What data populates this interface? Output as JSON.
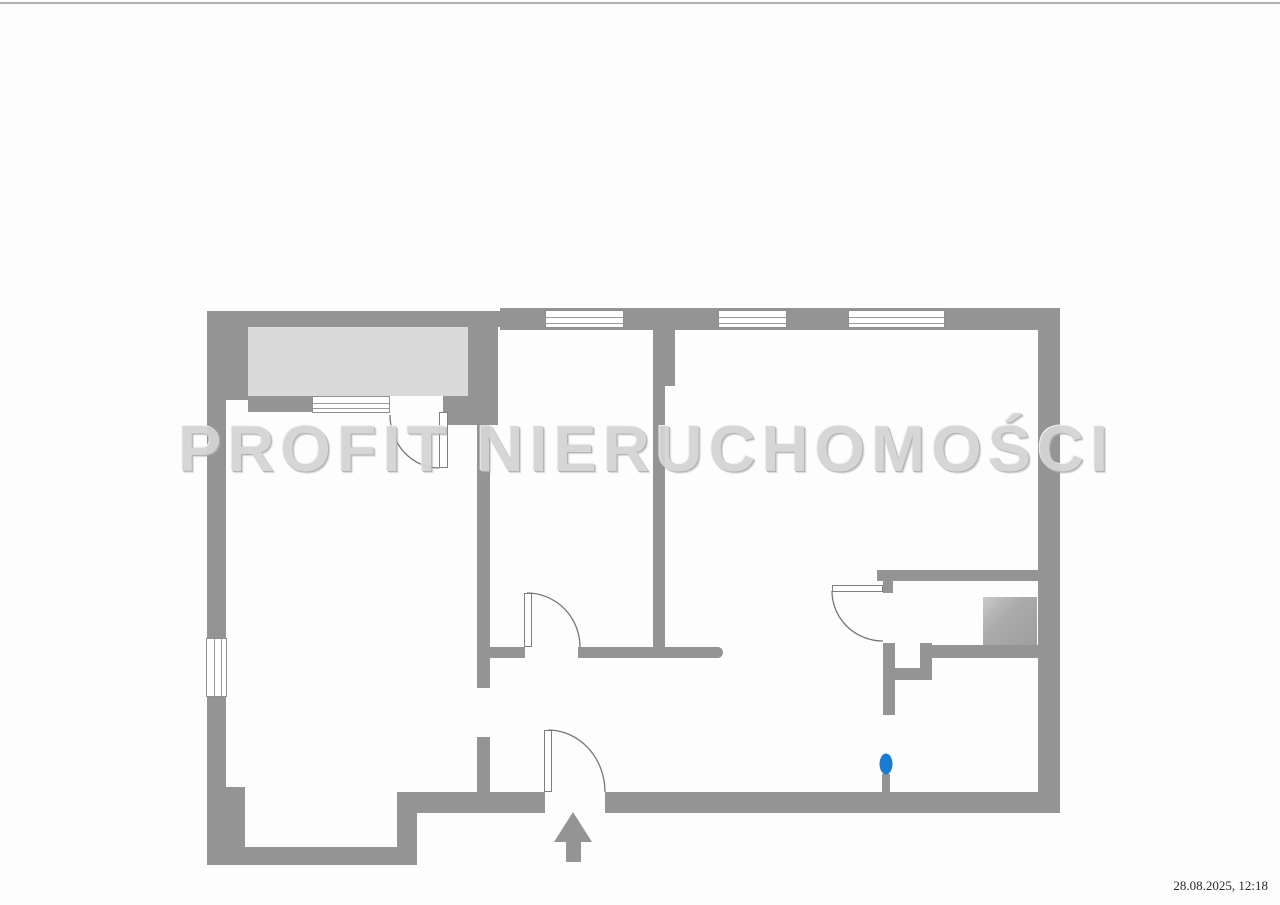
{
  "page": {
    "timestamp": "28.08.2025, 12:18",
    "background": "#fdfdfd",
    "scan_line_color": "#b2b2b2"
  },
  "watermark": {
    "text": "PROFIT NIERUCHOMOŚCI",
    "color": "#d4d4d4"
  },
  "colors": {
    "wall": "#949494",
    "balcony_fill": "#d9d9d9",
    "appliance_fill": "#a8a8a8",
    "marker_blue": "#1a7cd0",
    "door_line": "#767676"
  },
  "plan": {
    "walls": [
      {
        "name": "top-wall-balcony",
        "x": 207,
        "y": 311,
        "w": 293,
        "h": 16
      },
      {
        "name": "top-wall-main",
        "x": 500,
        "y": 308,
        "w": 560,
        "h": 22
      },
      {
        "name": "left-wall-upper",
        "x": 207,
        "y": 311,
        "w": 41,
        "h": 89
      },
      {
        "name": "left-wall",
        "x": 207,
        "y": 398,
        "w": 19,
        "h": 392
      },
      {
        "name": "left-wall-bottom",
        "x": 207,
        "y": 787,
        "w": 38,
        "h": 78
      },
      {
        "name": "bottom-wall-left",
        "x": 207,
        "y": 847,
        "w": 190,
        "h": 18
      },
      {
        "name": "bottom-step",
        "x": 397,
        "y": 792,
        "w": 20,
        "h": 73
      },
      {
        "name": "bottom-wall-mid",
        "x": 417,
        "y": 792,
        "w": 128,
        "h": 21
      },
      {
        "name": "bottom-wall-right",
        "x": 605,
        "y": 792,
        "w": 455,
        "h": 21
      },
      {
        "name": "right-wall",
        "x": 1038,
        "y": 308,
        "w": 22,
        "h": 505
      },
      {
        "name": "balcony-right-wall",
        "x": 468,
        "y": 327,
        "w": 30,
        "h": 70
      },
      {
        "name": "balcony-bottom-wall-left",
        "x": 248,
        "y": 396,
        "w": 65,
        "h": 16
      },
      {
        "name": "balcony-bottom-wall-right",
        "x": 443,
        "y": 396,
        "w": 55,
        "h": 29
      },
      {
        "name": "divider-left-upper",
        "x": 477,
        "y": 420,
        "w": 13,
        "h": 268
      },
      {
        "name": "divider-left-lower",
        "x": 477,
        "y": 737,
        "w": 13,
        "h": 56
      },
      {
        "name": "divider-mid-upper",
        "x": 653,
        "y": 330,
        "w": 22,
        "h": 56
      },
      {
        "name": "divider-mid-lower",
        "x": 653,
        "y": 385,
        "w": 12,
        "h": 273
      },
      {
        "name": "hall-wall-stub",
        "x": 490,
        "y": 647,
        "w": 35,
        "h": 11
      },
      {
        "name": "hall-wall-main",
        "x": 578,
        "y": 647,
        "w": 145,
        "h": 11,
        "r": "0 6px 6px 0"
      },
      {
        "name": "bath-top-wall",
        "x": 877,
        "y": 570,
        "w": 161,
        "h": 11
      },
      {
        "name": "bath-door-stub",
        "x": 883,
        "y": 581,
        "w": 10,
        "h": 12
      },
      {
        "name": "bath-wall-a",
        "x": 883,
        "y": 643,
        "w": 12,
        "h": 72
      },
      {
        "name": "bath-wall-b",
        "x": 895,
        "y": 668,
        "w": 35,
        "h": 12
      },
      {
        "name": "bath-wall-c",
        "x": 920,
        "y": 643,
        "w": 12,
        "h": 37
      },
      {
        "name": "bath-wall-d",
        "x": 932,
        "y": 645,
        "w": 106,
        "h": 13
      },
      {
        "name": "marker-stub",
        "x": 882,
        "y": 774,
        "w": 8,
        "h": 20
      },
      {
        "name": "entrance-arrow-shaft",
        "x": 566,
        "y": 840,
        "w": 15,
        "h": 22
      }
    ],
    "fills": [
      {
        "name": "balcony-floor",
        "x": 248,
        "y": 327,
        "w": 220,
        "h": 69,
        "kind": "balcony"
      },
      {
        "name": "bathroom-appliance",
        "x": 983,
        "y": 597,
        "w": 54,
        "h": 48,
        "kind": "appliance"
      }
    ],
    "windows": [
      {
        "name": "window-top-1",
        "x": 545,
        "y": 310,
        "w": 79,
        "h": 18,
        "o": "h"
      },
      {
        "name": "window-top-2",
        "x": 718,
        "y": 310,
        "w": 69,
        "h": 18,
        "o": "h"
      },
      {
        "name": "window-top-3",
        "x": 848,
        "y": 310,
        "w": 97,
        "h": 18,
        "o": "h"
      },
      {
        "name": "window-left",
        "x": 206,
        "y": 638,
        "w": 21,
        "h": 59,
        "o": "v"
      },
      {
        "name": "window-balcony",
        "x": 312,
        "y": 396,
        "w": 78,
        "h": 17,
        "o": "h"
      }
    ],
    "door_leaves": [
      {
        "name": "balcony-door-leaf",
        "x": 439,
        "y": 412,
        "w": 9,
        "h": 56
      },
      {
        "name": "kitchen-door-leaf",
        "x": 524,
        "y": 593,
        "w": 8,
        "h": 54
      },
      {
        "name": "entrance-door-leaf",
        "x": 544,
        "y": 730,
        "w": 8,
        "h": 62
      },
      {
        "name": "bathroom-door-leaf",
        "x": 832,
        "y": 585,
        "w": 51,
        "h": 7
      }
    ],
    "door_arcs": [
      {
        "name": "balcony-door-arc",
        "d": "M390,415 A49,53 0 0 0 439,468"
      },
      {
        "name": "kitchen-door-arc",
        "d": "M527,593 A53,54 0 0 1 580,647"
      },
      {
        "name": "entrance-door-arc",
        "d": "M548,730 A57,62 0 0 1 605,792"
      },
      {
        "name": "bathroom-door-arc",
        "d": "M832,591 A51,50 0 0 0 883,641"
      }
    ],
    "arrow_head_points": "573,812 592,842 554,842",
    "marker": {
      "cx": 886,
      "cy": 764,
      "rx": 6.5,
      "ry": 10.5
    }
  }
}
